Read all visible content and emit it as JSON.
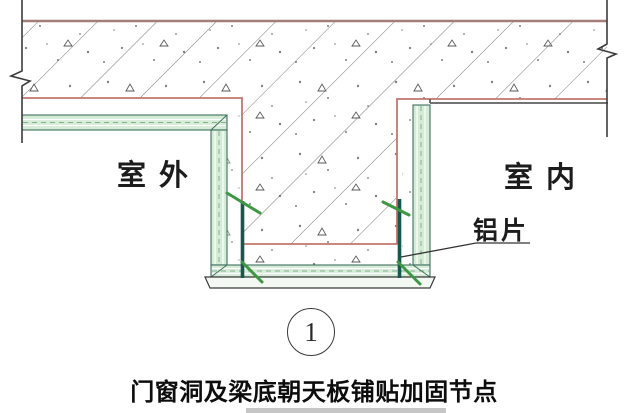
{
  "drawing_title": "门窗洞及梁底朝天板铺贴加固节点",
  "labels": {
    "outdoor": "室外",
    "indoor": "室内",
    "aluminum_sheet": "铝片",
    "detail_number": "1"
  },
  "caption": "门窗洞及梁底朝天板铺贴加固节点",
  "colors": {
    "outline_red": "#c4766b",
    "top_line": "#a57d78",
    "membrane_fill": "#d4ebd6",
    "membrane_border": "#3f6f60",
    "membrane_dash": "#86b193",
    "aluminum_teal": "#16584e",
    "tick_green": "#3e9743",
    "hatch_line": "#6a6a6a",
    "speck_gray": "#7d7d7d",
    "break_line": "#3c3c3c",
    "plaster_gray": "#5f5f5f",
    "board_fill": "#f3f8f3"
  }
}
